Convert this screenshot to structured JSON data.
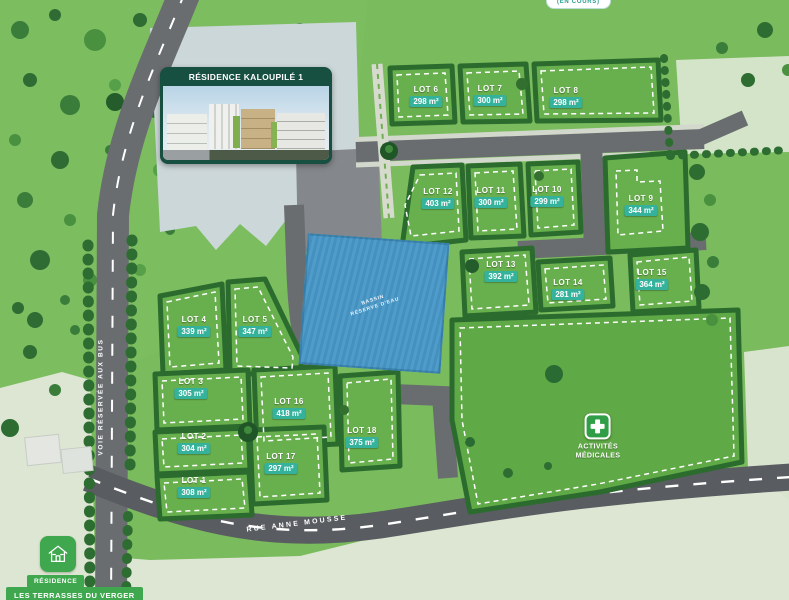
{
  "colors": {
    "teal_badge": "#35b29b",
    "teal_text": "#2a9d8f",
    "brand_green": "#3fa84e",
    "dark_green": "#174f41",
    "basin_blue": "#4490bf",
    "road_gray": "#6a6d70",
    "site_green": "#79bb5d",
    "pale_ground": "#dce6d2"
  },
  "status_pill": {
    "label": "(EN COURS)"
  },
  "residence_card": {
    "title": "RÉSIDENCE KALOUPILÉ 1"
  },
  "basin": {
    "line1": "BASSIN",
    "line2": "RÉSERVE D'EAU"
  },
  "medical_area": {
    "line1": "ACTIVITÉS",
    "line2": "MÉDICALES"
  },
  "roads": {
    "bus_lane": "VOIE RÉSERVÉE AUX BUS",
    "street": "RUE ANNE MOUSSE"
  },
  "residence_badge": {
    "top": "RÉSIDENCE",
    "bottom": "LES TERRASSES DU VERGER"
  },
  "lots": [
    {
      "name": "LOT 1",
      "area": "308 m²",
      "x": 194,
      "y": 487
    },
    {
      "name": "LOT 2",
      "area": "304 m²",
      "x": 194,
      "y": 443
    },
    {
      "name": "LOT 3",
      "area": "305 m²",
      "x": 191,
      "y": 388
    },
    {
      "name": "LOT 4",
      "area": "339 m²",
      "x": 194,
      "y": 326
    },
    {
      "name": "LOT 5",
      "area": "347 m²",
      "x": 255,
      "y": 326
    },
    {
      "name": "LOT 6",
      "area": "298 m²",
      "x": 426,
      "y": 96
    },
    {
      "name": "LOT 7",
      "area": "300 m²",
      "x": 490,
      "y": 95
    },
    {
      "name": "LOT 8",
      "area": "298 m²",
      "x": 566,
      "y": 97
    },
    {
      "name": "LOT 9",
      "area": "344 m²",
      "x": 641,
      "y": 205
    },
    {
      "name": "LOT 10",
      "area": "299 m²",
      "x": 547,
      "y": 196
    },
    {
      "name": "LOT 11",
      "area": "300 m²",
      "x": 491,
      "y": 197
    },
    {
      "name": "LOT 12",
      "area": "403 m²",
      "x": 438,
      "y": 198
    },
    {
      "name": "LOT 13",
      "area": "392 m²",
      "x": 501,
      "y": 271
    },
    {
      "name": "LOT 14",
      "area": "281 m²",
      "x": 568,
      "y": 289
    },
    {
      "name": "LOT 15",
      "area": "364 m²",
      "x": 652,
      "y": 279
    },
    {
      "name": "LOT 16",
      "area": "418 m²",
      "x": 289,
      "y": 408
    },
    {
      "name": "LOT 17",
      "area": "297 m²",
      "x": 281,
      "y": 463
    },
    {
      "name": "LOT 18",
      "area": "375 m²",
      "x": 362,
      "y": 437
    }
  ]
}
